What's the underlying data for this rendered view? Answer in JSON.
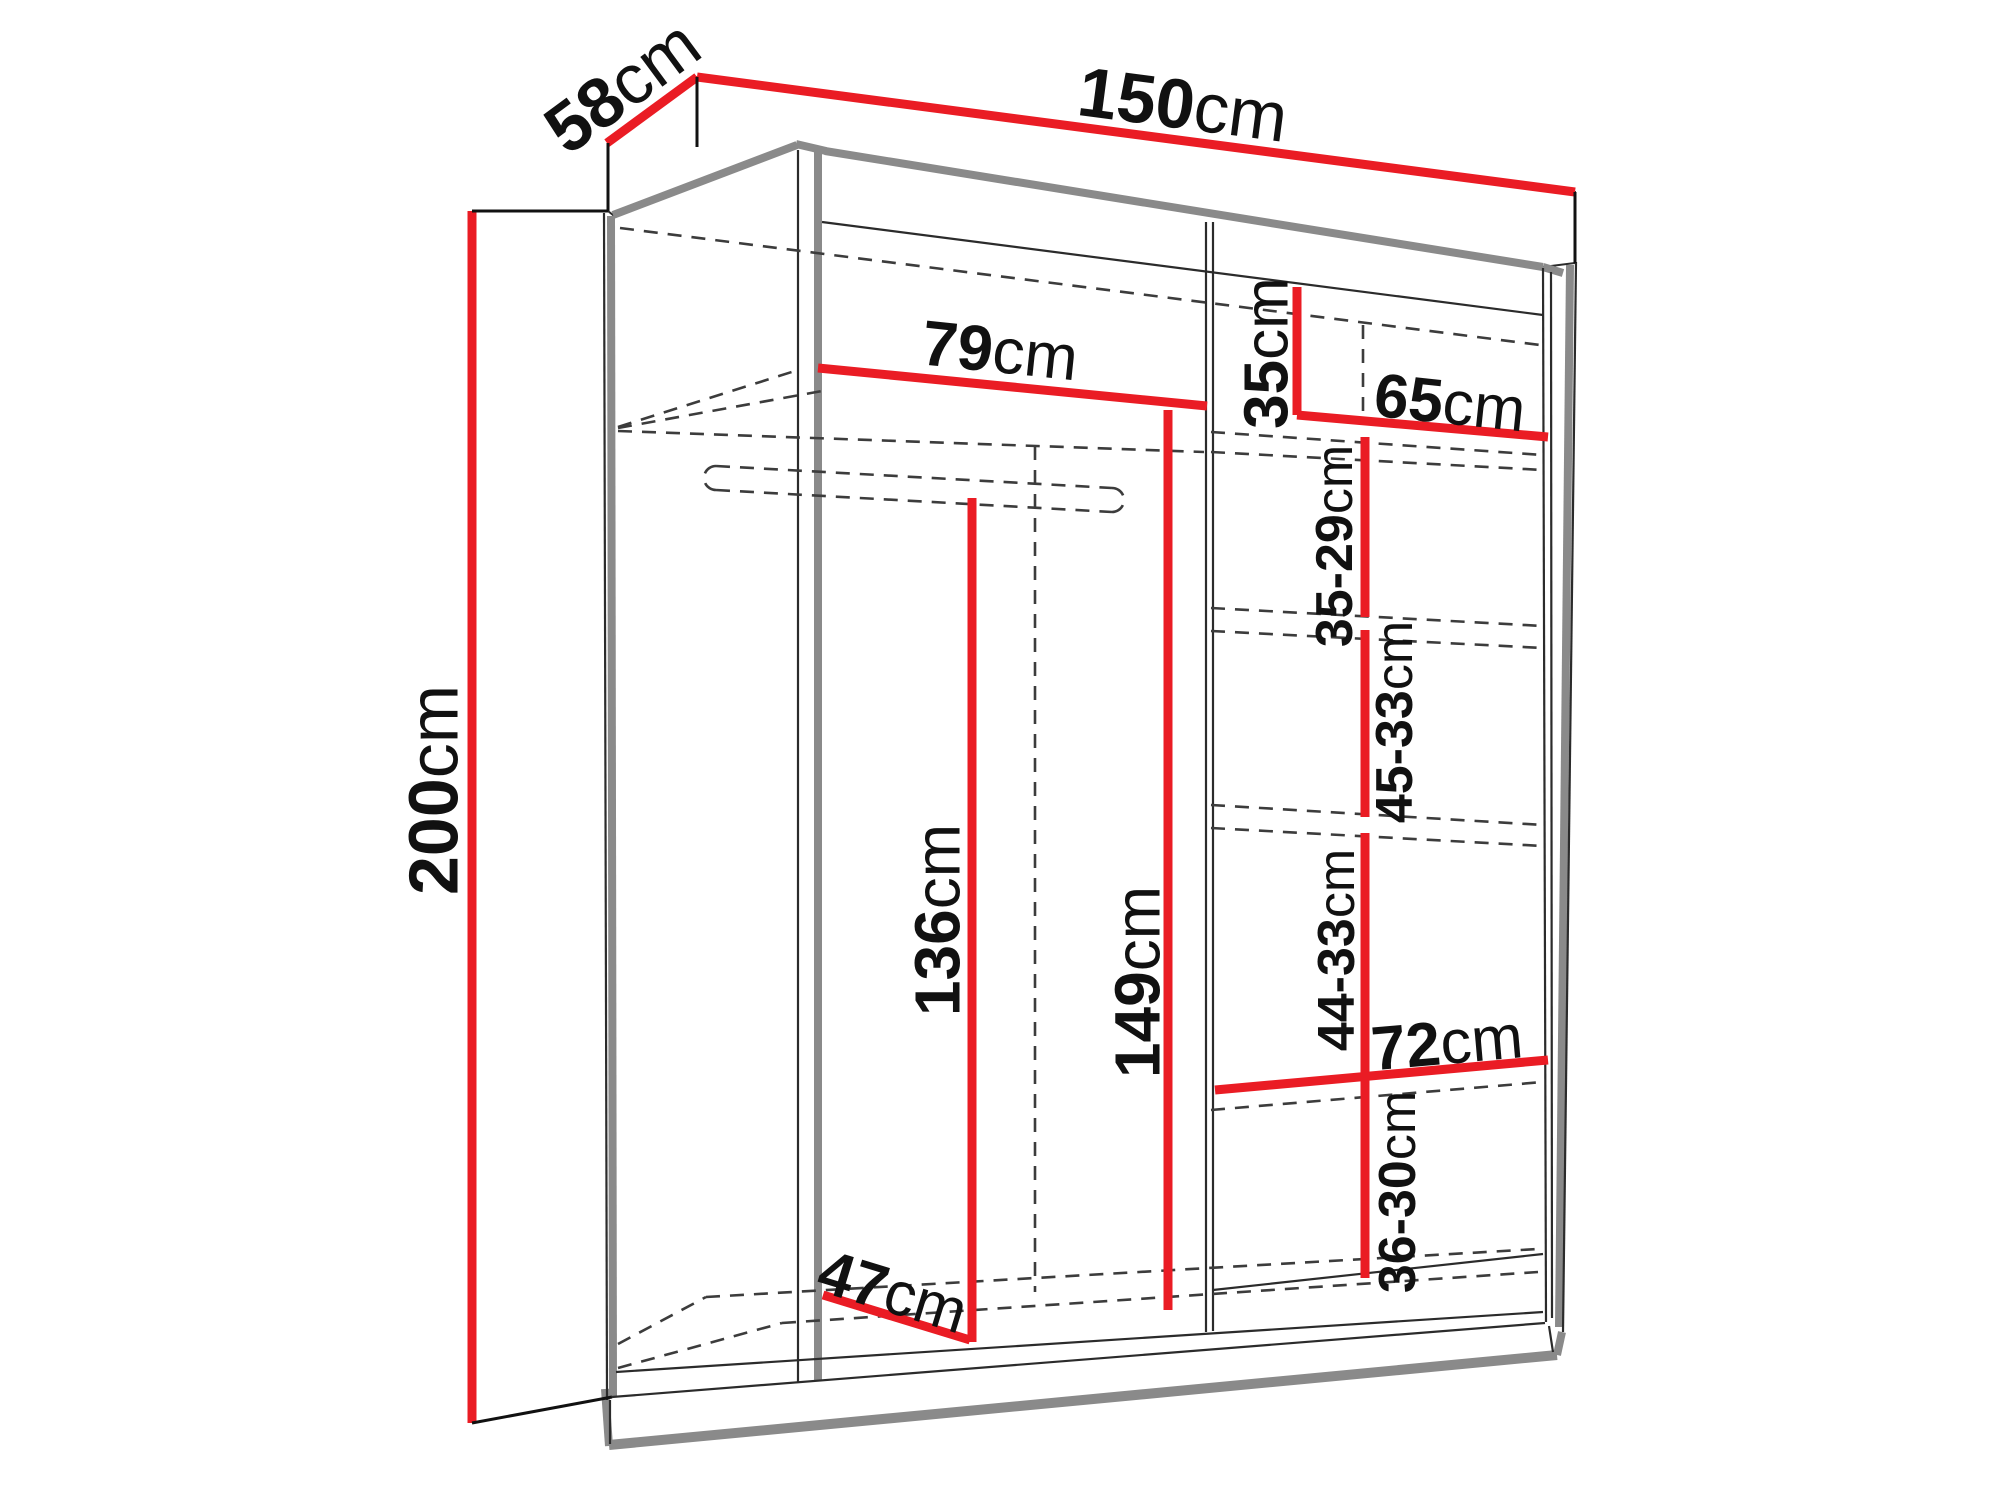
{
  "colors": {
    "red": "#ea1c24",
    "ink": "#111111",
    "ink2": "#2b2b2b",
    "gray": "#8a8a8a",
    "dash": "#3c3c3c",
    "bg": "#ffffff"
  },
  "diagram": {
    "type": "wardrobe-dimension-diagram",
    "dims": {
      "depth": {
        "value": "58",
        "unit": "cm"
      },
      "width": {
        "value": "150",
        "unit": "cm"
      },
      "height": {
        "value": "200",
        "unit": "cm"
      },
      "left_width": {
        "value": "79",
        "unit": "cm"
      },
      "top_compartment": {
        "value": "35",
        "unit": "cm"
      },
      "right_width": {
        "value": "65",
        "unit": "cm"
      },
      "gap1": {
        "value": "35-29",
        "unit": "cm"
      },
      "gap2": {
        "value": "45-33",
        "unit": "cm"
      },
      "hanging": {
        "value": "136",
        "unit": "cm"
      },
      "left_height": {
        "value": "149",
        "unit": "cm"
      },
      "gap3": {
        "value": "44-33",
        "unit": "cm"
      },
      "shelf_width": {
        "value": "72",
        "unit": "cm"
      },
      "gap4": {
        "value": "36-30",
        "unit": "cm"
      },
      "bottom_depth": {
        "value": "47",
        "unit": "cm"
      }
    }
  }
}
